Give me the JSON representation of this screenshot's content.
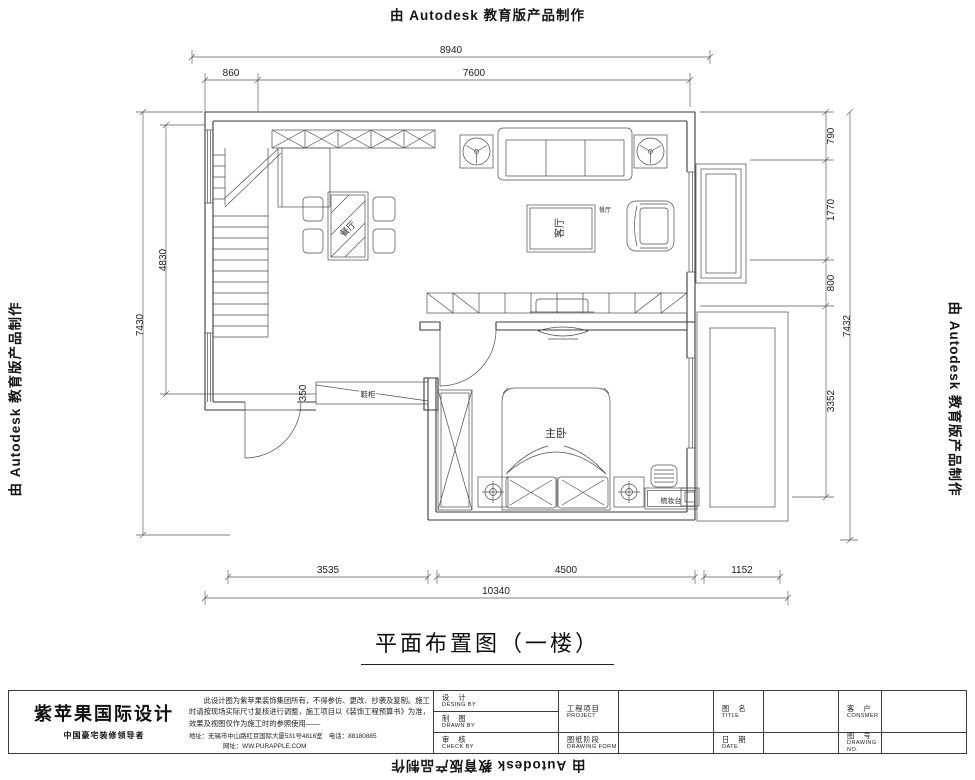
{
  "stamp": {
    "text": "由 Autodesk 教育版产品制作"
  },
  "plan": {
    "dims": {
      "top_overall": "8940",
      "top_left": "860",
      "top_right": "7600",
      "left_outer": "7430",
      "left_inner": "4830",
      "shoe_depth": "350",
      "right_1": "790",
      "right_2": "1770",
      "right_3": "800",
      "right_4": "3352",
      "right_overall": "7432",
      "bottom_1": "3535",
      "bottom_2": "4500",
      "bottom_3": "1152",
      "bottom_overall": "10340"
    },
    "labels": {
      "dining": "餐厅",
      "living_table": "客厅",
      "living_side": "餐厅",
      "master_bed": "主卧",
      "shoe_cabinet": "鞋柜",
      "dresser": "梳妆台"
    }
  },
  "title": {
    "text": "平面布置图（一楼）"
  },
  "titleblock": {
    "company": "紫苹果国际设计",
    "slogan": "中国豪宅装修领导者",
    "notice": "此设计图为紫苹果装饰集团所有，不得参仿、更改、抄袭及复制。施工时请按现场实际尺寸复核进行调整，施工项目以《装饰工程预算书》为准，效果及视图仅作为施工时的参照使用——",
    "address": "地址：无锡市中山路红豆国际大厦531号4816室　电话：88180885",
    "website": "网址：WW.PURAPPLE.COM",
    "fields": [
      {
        "cn": "设　计",
        "en": "DESING BY"
      },
      {
        "cn": "制　图",
        "en": "DRAWN BY"
      },
      {
        "cn": "审　核",
        "en": "CHECK BY"
      },
      {
        "cn": "工程项目",
        "en": "PROJECT"
      },
      {
        "cn": "图纸阶段",
        "en": "DRAWING FORM"
      },
      {
        "cn": "图　名",
        "en": "TITLE"
      },
      {
        "cn": "日　期",
        "en": "DATE"
      },
      {
        "cn": "客　户",
        "en": "CONSMER"
      },
      {
        "cn": "图　号",
        "en": "DRAWING NO."
      }
    ]
  }
}
